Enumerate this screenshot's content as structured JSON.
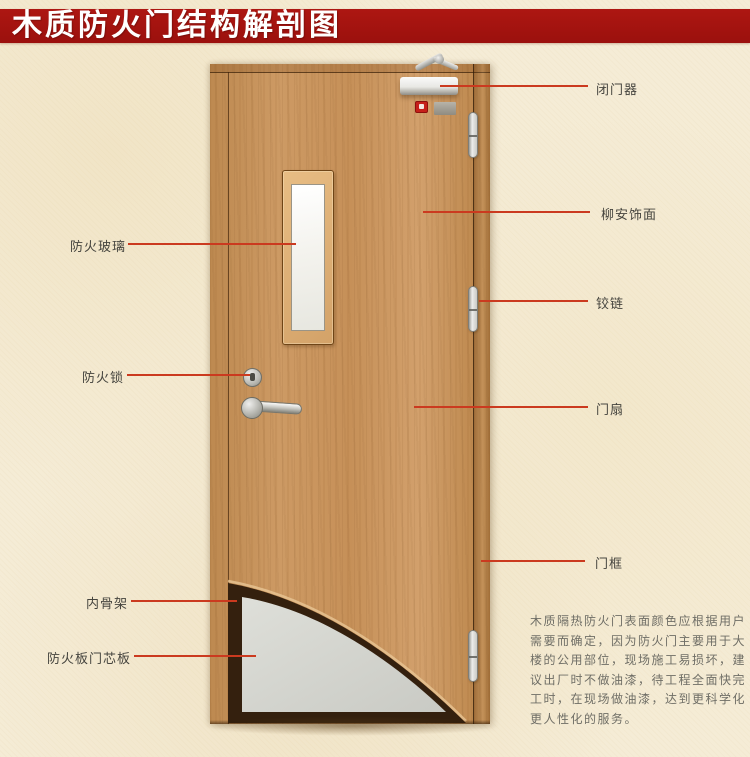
{
  "title": "木质防火门结构解剖图",
  "callouts": {
    "left": [
      {
        "label": "防火玻璃"
      },
      {
        "label": "防火锁"
      },
      {
        "label": "内骨架"
      },
      {
        "label": "防火板门芯板"
      }
    ],
    "right": [
      {
        "label": "闭门器"
      },
      {
        "label": "柳安饰面"
      },
      {
        "label": "铰链"
      },
      {
        "label": "门扇"
      },
      {
        "label": "门框"
      }
    ]
  },
  "description": {
    "lines": [
      "木质隔热防火门表面颜色应根据用户",
      "需要而确定，因为防火门主要用于大",
      "楼的公用部位，现场施工易损坏，建",
      "议出厂时不做油漆，待工程全面快完",
      "工时，在现场做油漆，达到更科学化",
      "更人性化的服务。"
    ]
  },
  "colors": {
    "banner_red": "#a01110",
    "callout_line_red": "#cb3a1f",
    "label_text": "#46453f",
    "background_beige": "#f5ecd6",
    "door_wood": "#c9945c",
    "glass_white": "#f7f6f1",
    "core_gray": "#d7d7d1",
    "inner_frame_dark": "#34200e"
  }
}
